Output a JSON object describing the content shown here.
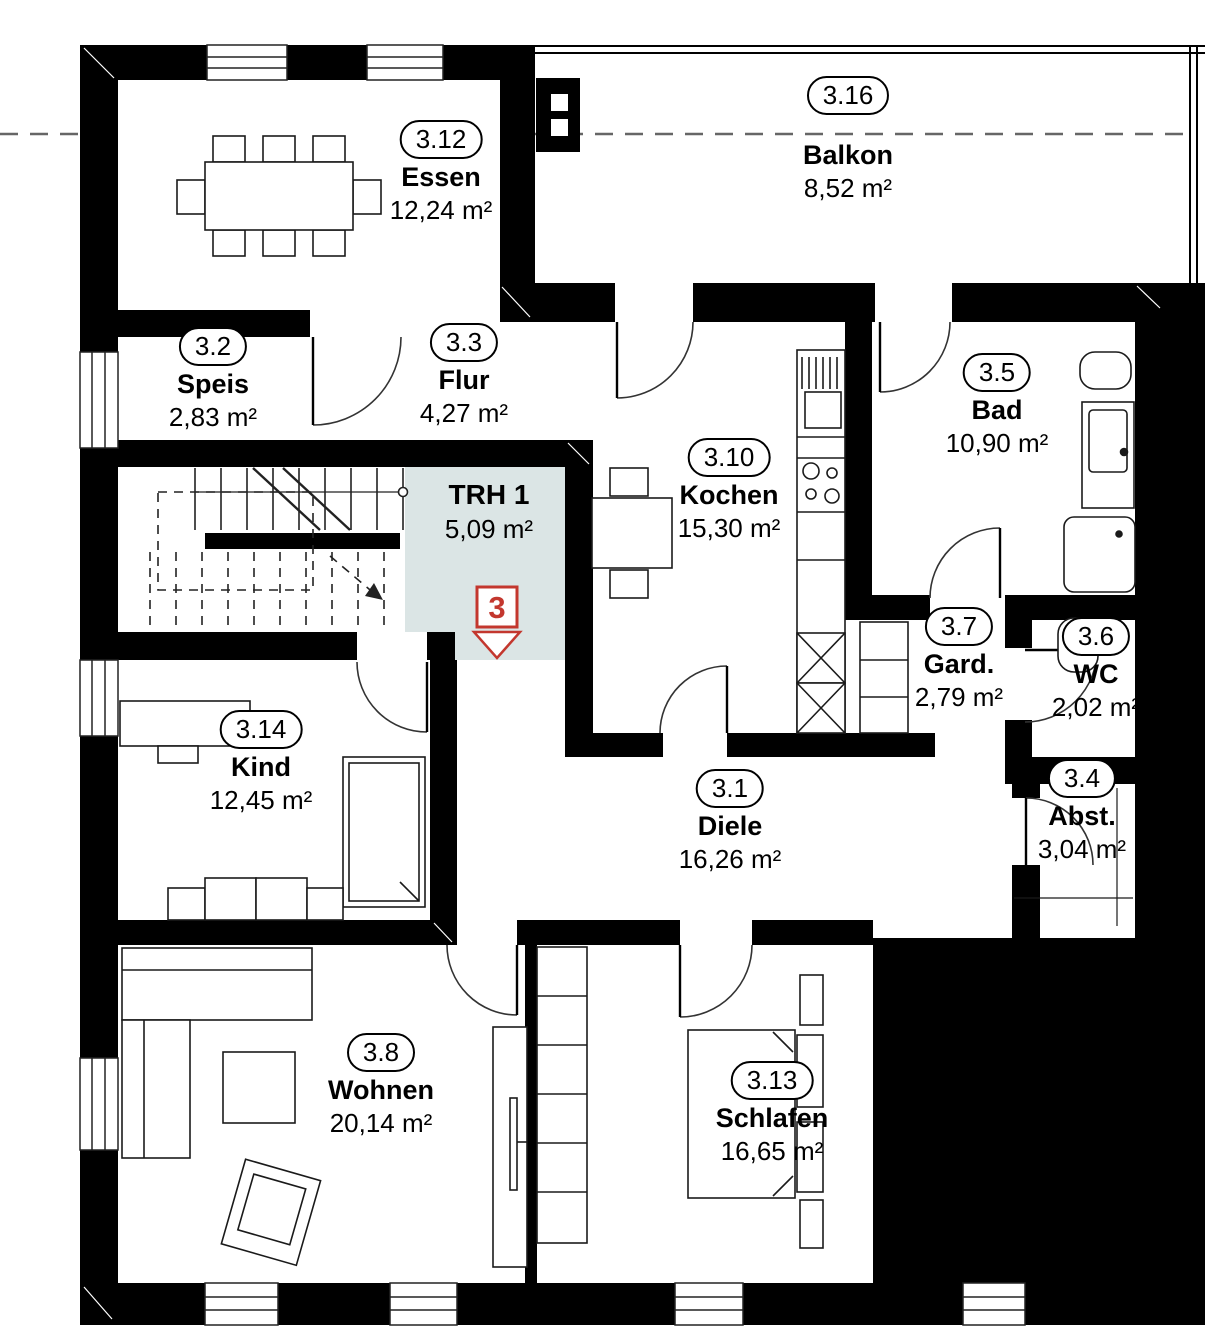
{
  "rooms": [
    {
      "id": "3.12",
      "name": "Essen",
      "area": "12,24 m²"
    },
    {
      "id": "3.16",
      "name": "Balkon",
      "area": "8,52 m²"
    },
    {
      "id": "3.2",
      "name": "Speis",
      "area": "2,83 m²"
    },
    {
      "id": "3.3",
      "name": "Flur",
      "area": "4,27 m²"
    },
    {
      "id": "",
      "name": "TRH 1",
      "area": "5,09 m²"
    },
    {
      "id": "3.10",
      "name": "Kochen",
      "area": "15,30 m²"
    },
    {
      "id": "3.5",
      "name": "Bad",
      "area": "10,90 m²"
    },
    {
      "id": "3.7",
      "name": "Gard.",
      "area": "2,79 m²"
    },
    {
      "id": "3.6",
      "name": "WC",
      "area": "2,02 m²"
    },
    {
      "id": "3.14",
      "name": "Kind",
      "area": "12,45 m²"
    },
    {
      "id": "3.1",
      "name": "Diele",
      "area": "16,26 m²"
    },
    {
      "id": "3.4",
      "name": "Abst.",
      "area": "3,04 m²"
    },
    {
      "id": "3.8",
      "name": "Wohnen",
      "area": "20,14 m²"
    },
    {
      "id": "3.13",
      "name": "Schlafen",
      "area": "16,65 m²"
    }
  ],
  "entrance_marker": {
    "number": "3"
  },
  "colors": {
    "wall": "#000000",
    "trh_fill": "#dbe5e5",
    "marker_red": "#c3372e"
  }
}
